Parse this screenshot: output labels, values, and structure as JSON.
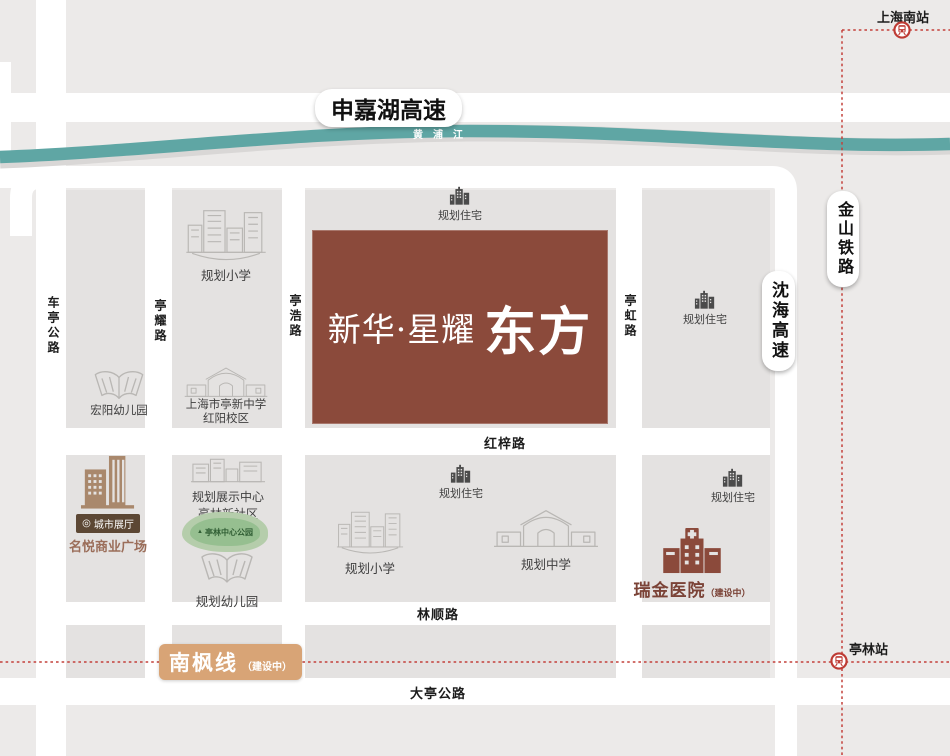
{
  "project": {
    "name": "新华·星耀",
    "name2": "东方"
  },
  "highways": {
    "shenjiahu": "申嘉湖高速",
    "shenhai": "沈海高速",
    "jinshan_railway": "金山铁路"
  },
  "river": {
    "name": "黄浦江"
  },
  "roads": {
    "cheting": "车亭公路",
    "tingyao": "亭耀路",
    "tinghao": "亭浩路",
    "tinghong": "亭虹路",
    "hongzi": "红梓路",
    "linshun": "林顺路",
    "dating": "大亭公路"
  },
  "metro": {
    "nanfeng_line": "南枫线",
    "nanfeng_status": "（建设中）",
    "station_south": "上海南站",
    "station_tinglin": "亭林站"
  },
  "pois": {
    "residential_top": "规划住宅",
    "residential_right_top": "规划住宅",
    "residential_mid": "规划住宅",
    "residential_right_bottom": "规划住宅",
    "primary_school_top": "规划小学",
    "primary_school_mid": "规划小学",
    "middle_school_mid": "规划中学",
    "hongyang_kindergarten": "宏阳幼儿园",
    "planned_kindergarten": "规划幼儿园",
    "tingxin_school_line1": "上海市亭新中学",
    "tingxin_school_line2": "红阳校区",
    "exhibition_line1": "规划展示中心",
    "exhibition_line2": "亭林新社区",
    "park": "亭林中心公园",
    "city_hall": "城市展厅",
    "mingyue_plaza": "名悦商业广场",
    "ruijin_hospital": "瑞金医院",
    "ruijin_status": "（建设中）"
  },
  "icons": {
    "pin": "◎",
    "tree": "▲"
  },
  "colors": {
    "project_brown": "#8B4A3B",
    "river_teal": "#5FA6A4",
    "railway_red": "#C3403A",
    "nanfeng_tan": "#D8A476",
    "road_white": "#FFFFFF",
    "block_gray": "#E4E2E1"
  }
}
